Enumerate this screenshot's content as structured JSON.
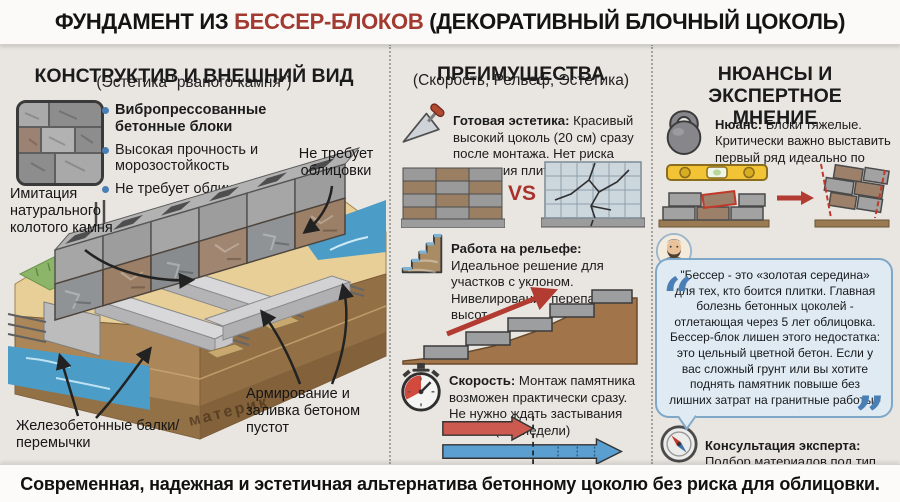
{
  "title": {
    "prefix": "ФУНДАМЕНТ ИЗ ",
    "highlight": "БЕССЕР-БЛОКОВ",
    "suffix": " (ДЕКОРАТИВНЫЙ БЛОЧНЫЙ ЦОКОЛЬ)"
  },
  "left": {
    "heading": "КОНСТРУКТИВ И ВНЕШНИЙ ВИД",
    "subheading": "(Эстетика \"рваного камня\")",
    "bullets": [
      {
        "label": "Вибропрессованные бетонные блоки",
        "bold": true
      },
      {
        "label": "Высокая прочность и морозостойкость",
        "bold": false
      },
      {
        "label": "Не требует облицовки",
        "bold": false
      }
    ],
    "labels": {
      "imitation": "Имитация натурального колотого камня",
      "no_cladding": "Не требует облицовки",
      "beams": "Железобетонные балки/перемычки",
      "bedrock": "материк",
      "reinforcement": "Армирование и заливка бетоном пустот"
    }
  },
  "middle": {
    "heading": "ПРЕИМУЩЕСТВА",
    "subheading": "(Скорость, Рельеф, Эстетика)",
    "vs_label": "VS",
    "items": [
      {
        "icon": "trowel-icon",
        "title": "Готовая эстетика:",
        "text": " Красивый высокий цоколь (20 см) сразу после монтажа. Нет риска отпадания плитки"
      },
      {
        "icon": "stairs-icon",
        "title": "Работа на рельефе:",
        "text": " Идеальное решение для участков с уклоном. Нивелирование перепадов высот"
      },
      {
        "icon": "stopwatch-icon",
        "title": "Скорость:",
        "text": " Монтаж памятника возможен практически сразу. Не нужно ждать застывания бетона (2-3 недели)"
      }
    ]
  },
  "right": {
    "heading": "НЮАНСЫ И ЭКСПЕРТНОЕ МНЕНИЕ",
    "nuance": {
      "icon": "kettlebell-icon",
      "title": "Нюанс:",
      "text": " Блоки тяжелые. Критически важно выставить первый ряд идеально по уровню"
    },
    "expert": {
      "title": "Мнение эксперта",
      "name": " (Марк Каменев):"
    },
    "quote_open": "“",
    "quote_close": "”",
    "quote": "\"Бессер - это «золотая середина» для тех, кто боится плитки. Главная болезнь бетонных цоколей - отлетающая через 5 лет облицовка. Бессер-блок лишен этого недостатка: это цельный цветной бетон. Если у вас сложный грунт или вы хотите поднять памятник повыше без лишних затрат на гранитные работы - это ваш выбор\"",
    "consult": {
      "icon": "compass-icon",
      "title": "Консультация эксперта:",
      "text": "Подбор материалов под тип почвы"
    }
  },
  "footer": "Современная, надежная и эстетичная альтернатива бетонному цоколю без риска для облицовки.",
  "colors": {
    "accent_red": "#a33a31",
    "vs_red": "#a8322c",
    "bullet_blue": "#4a7fb5",
    "water_blue": "#4b9cc7",
    "sand": "#e7cf97",
    "soil_brown": "#a8835a",
    "grass_green": "#8cb569",
    "level_yellow": "#f2c335",
    "bubble_bg": "#dfeaf2",
    "bubble_border": "#7fa8c8",
    "arrow_red": "#cd5a50",
    "arrow_blue": "#5b9fd0"
  }
}
